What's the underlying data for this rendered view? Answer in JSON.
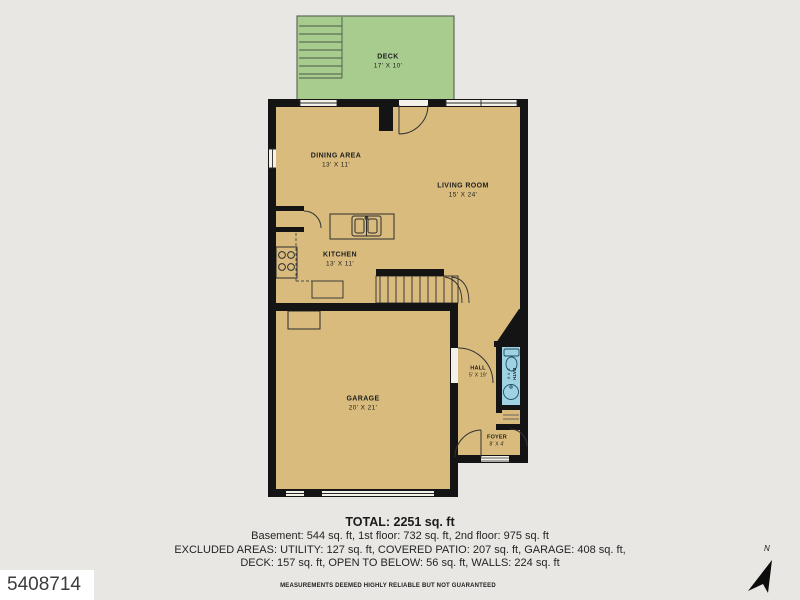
{
  "colors": {
    "background": "#e8e7e4",
    "floor": "#d8bb7d",
    "deck": "#a8cc8e",
    "bath": "#9fd2e3",
    "wall": "#141414",
    "line": "#333333",
    "opening": "#f4f1ea"
  },
  "plan": {
    "rooms": [
      {
        "name": "DECK",
        "dims": "17' X 10'"
      },
      {
        "name": "DINING AREA",
        "dims": "13' X 11'"
      },
      {
        "name": "LIVING ROOM",
        "dims": "15' X 24'"
      },
      {
        "name": "KITCHEN",
        "dims": "13' X 11'"
      },
      {
        "name": "GARAGE",
        "dims": "20' X 21'"
      },
      {
        "name": "HALL",
        "dims": "5' X 19'"
      },
      {
        "name": "FOYER",
        "dims": "8' X 4'"
      },
      {
        "name": "BATH",
        "dims": "3' X 8'"
      }
    ]
  },
  "summary": {
    "total": "TOTAL: 2251 sq. ft",
    "floors": "Basement: 544 sq. ft, 1st floor: 732 sq. ft, 2nd floor: 975 sq. ft",
    "excluded_1": "EXCLUDED AREAS: UTILITY: 127 sq. ft, COVERED PATIO: 207 sq. ft, GARAGE: 408 sq. ft,",
    "excluded_2": "DECK: 157 sq. ft, OPEN TO BELOW: 56 sq. ft, WALLS: 224 sq. ft"
  },
  "footer": {
    "listing_id": "5408714",
    "disclaimer": "MEASUREMENTS DEEMED HIGHLY RELIABLE BUT NOT GUARANTEED",
    "compass": "N"
  }
}
